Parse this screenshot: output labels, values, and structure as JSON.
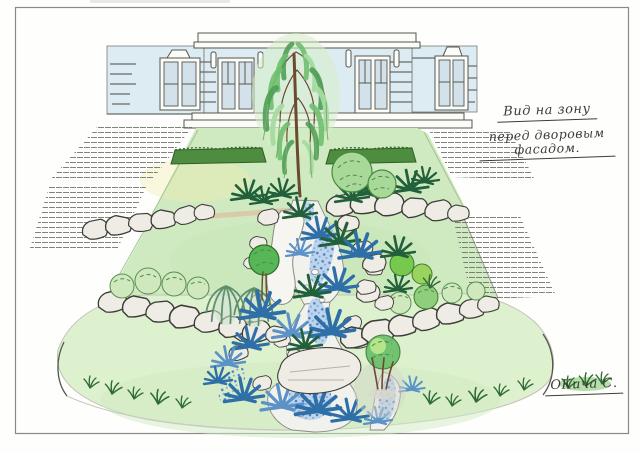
{
  "annotation": {
    "line1": "Вид на зону",
    "line2": "перед дворовым фасадом."
  },
  "signature": "ОКича С.",
  "colors": {
    "paper": "#fefefc",
    "frame_line": "#8a8a85",
    "ink": "#3c3c38",
    "building_wall": "#ddecf2",
    "building_trim": "#fbfbf8",
    "glass": "#d3e2ea",
    "lawn_green": "#cfe9c1",
    "lawn_light": "#ddf1cf",
    "hedge_green": "#4e8c3f",
    "foliage_green": "#6fbf6f",
    "foliage_light": "#a9d89b",
    "conifer_blue": "#2f6fa8",
    "conifer_blue_light": "#5b92c8",
    "conifer_dark": "#21603a",
    "water_blue": "#4d7fc2",
    "water_tint": "#bcd4ec",
    "stone_fill": "#eeece4",
    "trunk_brown": "#6b4a2e",
    "mulch_tan": "#dcc6a4",
    "step_line": "#6b6b66"
  }
}
